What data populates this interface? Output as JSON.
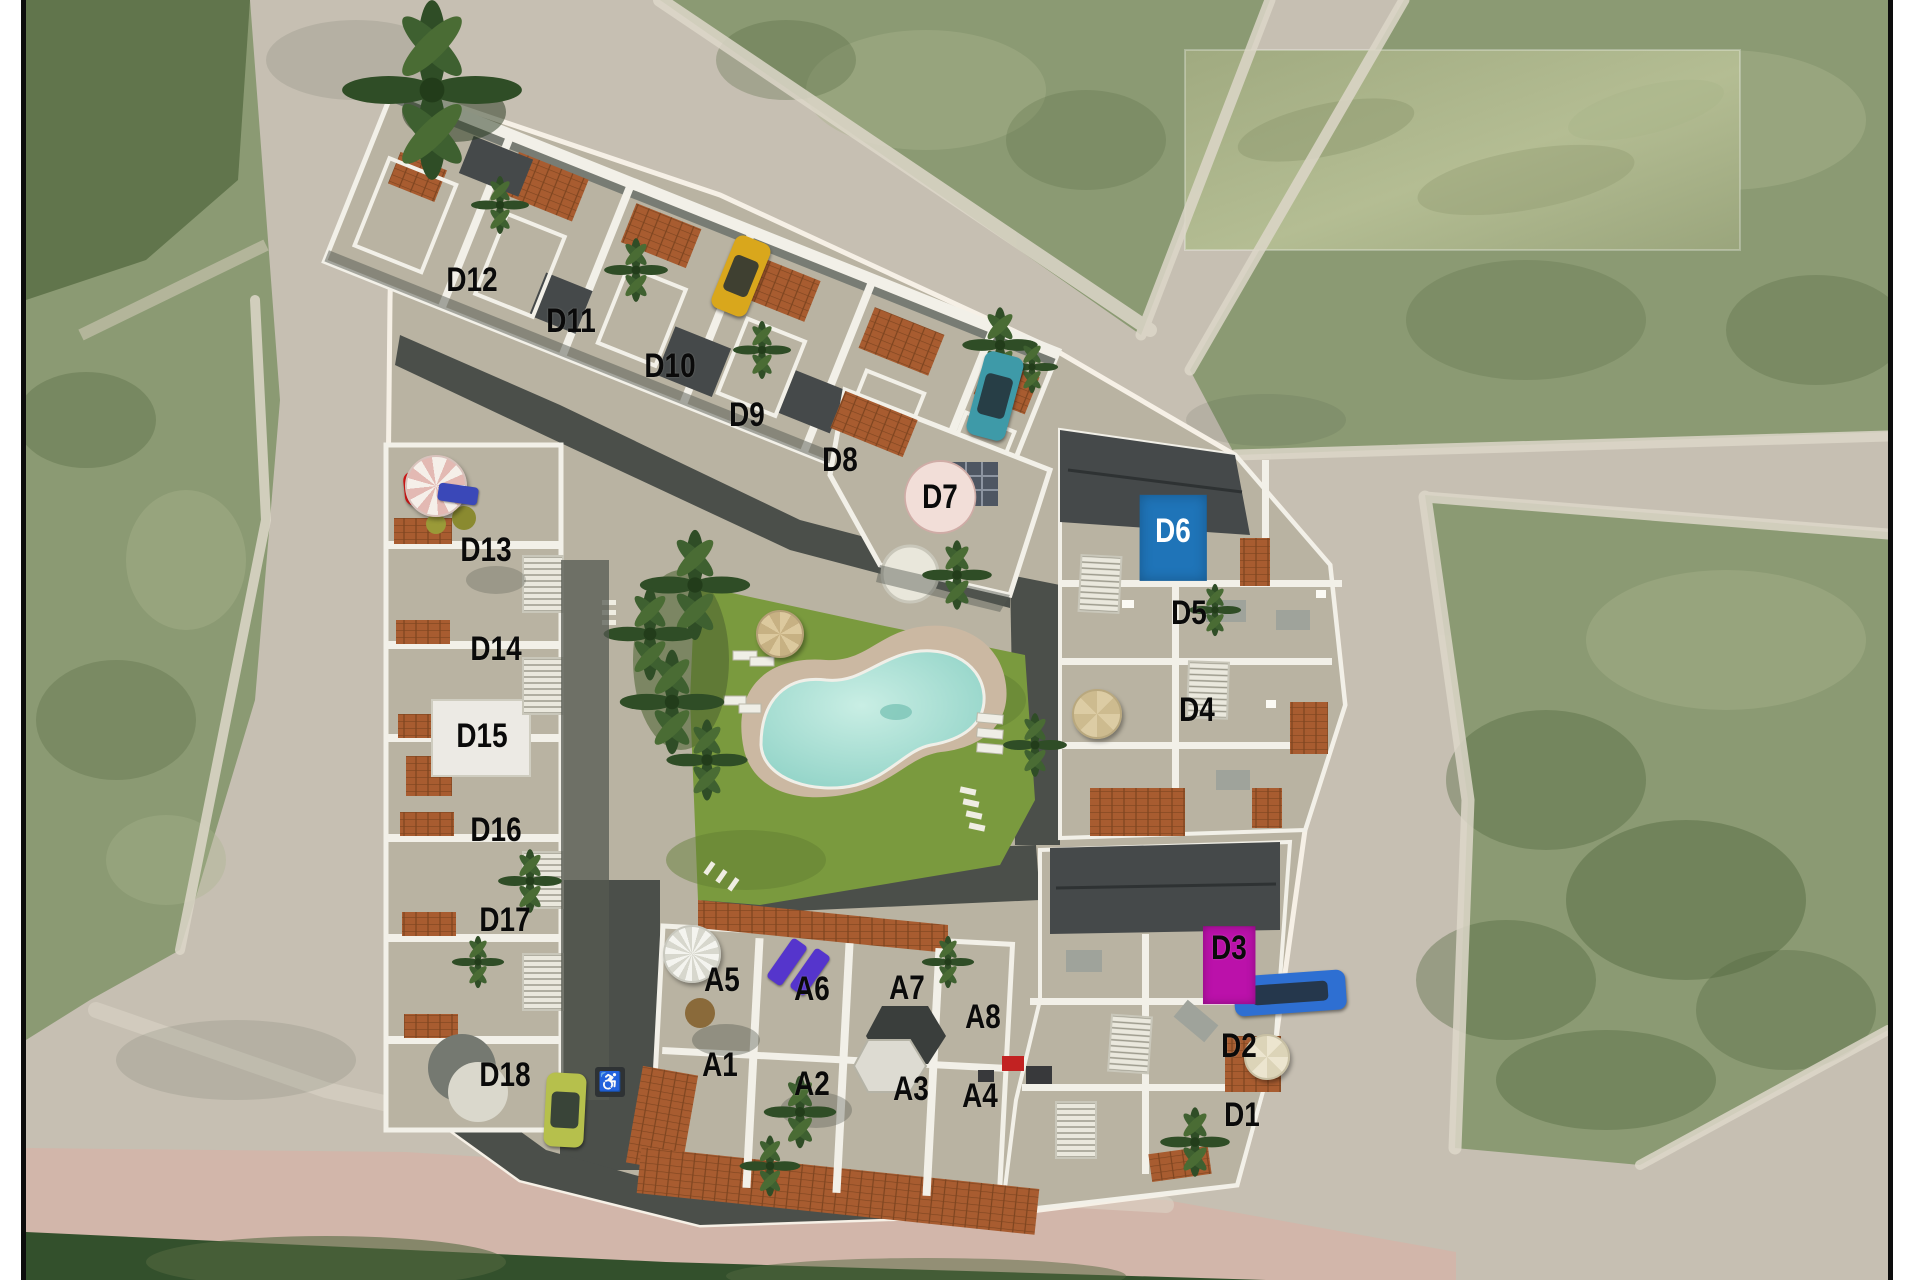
{
  "site": {
    "units": [
      {
        "id": "D12",
        "x": 446,
        "y": 280,
        "style": "plain"
      },
      {
        "id": "D11",
        "x": 545,
        "y": 321,
        "style": "plain"
      },
      {
        "id": "D10",
        "x": 644,
        "y": 366,
        "style": "plain"
      },
      {
        "id": "D9",
        "x": 721,
        "y": 415,
        "style": "plain"
      },
      {
        "id": "D8",
        "x": 814,
        "y": 460,
        "style": "plain"
      },
      {
        "id": "D7",
        "x": 914,
        "y": 497,
        "style": "badge-pink"
      },
      {
        "id": "D13",
        "x": 460,
        "y": 550,
        "style": "plain"
      },
      {
        "id": "D14",
        "x": 470,
        "y": 649,
        "style": "plain"
      },
      {
        "id": "D15",
        "x": 456,
        "y": 736,
        "style": "plain"
      },
      {
        "id": "D16",
        "x": 470,
        "y": 830,
        "style": "plain"
      },
      {
        "id": "D17",
        "x": 479,
        "y": 920,
        "style": "plain"
      },
      {
        "id": "D18",
        "x": 479,
        "y": 1075,
        "style": "plain"
      },
      {
        "id": "D6",
        "x": 1147,
        "y": 531,
        "style": "box-blue"
      },
      {
        "id": "D5",
        "x": 1163,
        "y": 613,
        "style": "plain"
      },
      {
        "id": "D4",
        "x": 1171,
        "y": 710,
        "style": "plain"
      },
      {
        "id": "D3",
        "x": 1203,
        "y": 948,
        "style": "box-magenta"
      },
      {
        "id": "D2",
        "x": 1213,
        "y": 1046,
        "style": "plain"
      },
      {
        "id": "D1",
        "x": 1216,
        "y": 1115,
        "style": "plain"
      },
      {
        "id": "A5",
        "x": 696,
        "y": 980,
        "style": "plain"
      },
      {
        "id": "A6",
        "x": 786,
        "y": 989,
        "style": "plain"
      },
      {
        "id": "A7",
        "x": 881,
        "y": 988,
        "style": "plain"
      },
      {
        "id": "A8",
        "x": 957,
        "y": 1017,
        "style": "plain"
      },
      {
        "id": "A1",
        "x": 694,
        "y": 1065,
        "style": "plain"
      },
      {
        "id": "A2",
        "x": 786,
        "y": 1084,
        "style": "plain"
      },
      {
        "id": "A3",
        "x": 885,
        "y": 1089,
        "style": "plain"
      },
      {
        "id": "A4",
        "x": 954,
        "y": 1096,
        "style": "plain"
      }
    ],
    "cars": [
      {
        "name": "yellow-car",
        "color": "#d9a71c",
        "x": 715,
        "y": 276,
        "w": 38,
        "h": 78,
        "rot": 22
      },
      {
        "name": "teal-car",
        "color": "#3e9aa8",
        "x": 969,
        "y": 396,
        "w": 40,
        "h": 86,
        "rot": 15
      },
      {
        "name": "red-car",
        "color": "#cc1616",
        "x": 401,
        "y": 487,
        "w": 46,
        "h": 34,
        "rot": -6
      },
      {
        "name": "blue-car",
        "color": "#2e6fd2",
        "x": 1264,
        "y": 993,
        "w": 112,
        "h": 40,
        "rot": -4
      },
      {
        "name": "lime-car",
        "color": "#b6c04c",
        "x": 539,
        "y": 1110,
        "w": 40,
        "h": 74,
        "rot": 3
      }
    ],
    "umbrellas": [
      {
        "name": "striped-parasol",
        "type": "pink-striped",
        "x": 408,
        "y": 484,
        "r": 29
      },
      {
        "name": "thatch-parasol",
        "type": "thatch",
        "x": 752,
        "y": 632,
        "r": 22
      },
      {
        "name": "beige-parasol",
        "type": "beige",
        "x": 1069,
        "y": 712,
        "r": 23
      },
      {
        "name": "pale-parasol",
        "type": "pale",
        "x": 1239,
        "y": 1055,
        "r": 21
      },
      {
        "name": "white-spiral-parasol",
        "type": "white-spiral",
        "x": 664,
        "y": 952,
        "r": 27
      }
    ],
    "sofa": {
      "x": 432,
      "y": 494,
      "w": 40,
      "h": 18,
      "rot": 8,
      "color": "#3a48b8"
    },
    "handicap": {
      "symbol": "♿",
      "x": 584,
      "y": 1082,
      "size": 30
    },
    "purple_loungers": [
      {
        "x": 761,
        "y": 962,
        "w": 18,
        "h": 48,
        "rot": 35
      },
      {
        "x": 784,
        "y": 972,
        "w": 18,
        "h": 48,
        "rot": 35
      }
    ]
  },
  "colors": {
    "road": "#c6bfb2",
    "walk": "#ddd7c9",
    "field": "#8b9a73",
    "field_dark": "#53683f",
    "field_light": "#a9b48b",
    "site": "#b9b3a2",
    "drive": "#4b4f4a",
    "lawn": "#7a9a3e",
    "lawn_dark": "#5f7d31",
    "pool": "#9fd8cc",
    "pool_light": "#c6ece3",
    "deck": "#cbb8a2",
    "terracotta": "#a85c30",
    "terracotta_dark": "#7e4520",
    "roof_dark": "#45494a",
    "wall_white": "#f2f0e8",
    "accent_blue": "#1f74b8",
    "accent_magenta": "#bb11aa",
    "badge_pink": "#f2ded8",
    "label_black": "#0a0a0a",
    "pink_road": "#d5b4a8",
    "bottom_green": "#33502c",
    "blur_patch_a": "#a3ad82",
    "blur_patch_b": "#b6bf95"
  }
}
